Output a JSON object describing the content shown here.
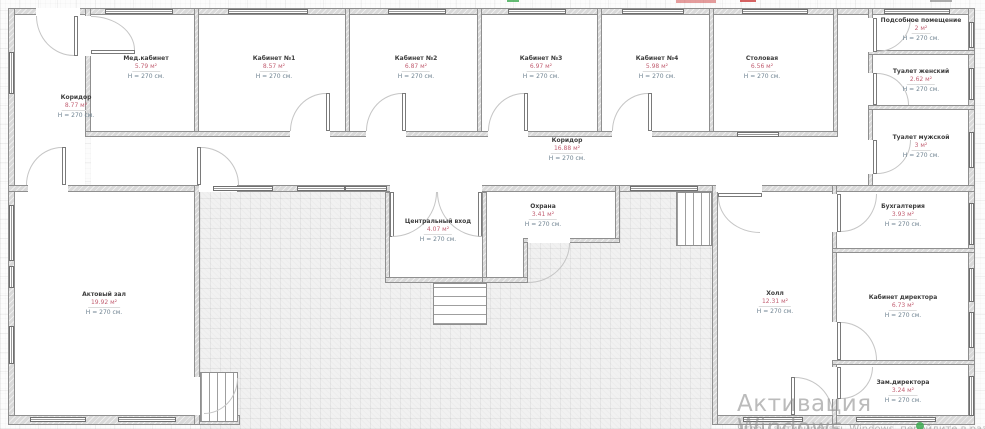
{
  "watermark": {
    "line1": "Активация Windows",
    "line2": "Чтобы активировать Windows, перейдите в раздел \"Параметры\"."
  },
  "rooms": [
    {
      "id": "corridor-left",
      "name": "Коридор",
      "area": "8.77 м²",
      "height": "H = 270 см."
    },
    {
      "id": "med-office",
      "name": "Мед.кабинет",
      "area": "5.79 м²",
      "height": "H = 270 см."
    },
    {
      "id": "office-1",
      "name": "Кабинет №1",
      "area": "8.57 м²",
      "height": "H = 270 см."
    },
    {
      "id": "office-2",
      "name": "Кабинет №2",
      "area": "6.87 м²",
      "height": "H = 270 см."
    },
    {
      "id": "office-3",
      "name": "Кабинет №3",
      "area": "6.97 м²",
      "height": "H = 270 см."
    },
    {
      "id": "office-4",
      "name": "Кабинет №4",
      "area": "5.98 м²",
      "height": "H = 270 см."
    },
    {
      "id": "dining-room",
      "name": "Столовая",
      "area": "6.56 м²",
      "height": "H = 270 см."
    },
    {
      "id": "utility-room",
      "name": "Подсобное помещение",
      "area": "2 м²",
      "height": "H = 270 см."
    },
    {
      "id": "wc-women",
      "name": "Туалет женский",
      "area": "2.62 м²",
      "height": "H = 270 см."
    },
    {
      "id": "wc-men",
      "name": "Туалет мужской",
      "area": "3 м²",
      "height": "H = 270 см."
    },
    {
      "id": "corridor-main",
      "name": "Коридор",
      "area": "16.88 м²",
      "height": "H = 270 см."
    },
    {
      "id": "assembly-hall",
      "name": "Актовый зал",
      "area": "19.92 м²",
      "height": "H = 270 см."
    },
    {
      "id": "main-entrance",
      "name": "Центральный вход",
      "area": "4.07 м²",
      "height": "H = 270 см."
    },
    {
      "id": "security",
      "name": "Охрана",
      "area": "3.41 м²",
      "height": "H = 270 см."
    },
    {
      "id": "hall",
      "name": "Холл",
      "area": "12.31 м²",
      "height": "H = 270 см."
    },
    {
      "id": "accounting",
      "name": "Бухгалтерия",
      "area": "3.93 м²",
      "height": "H = 270 см."
    },
    {
      "id": "director-office",
      "name": "Кабинет директора",
      "area": "6.73 м²",
      "height": "H = 270 см."
    },
    {
      "id": "deputy-director",
      "name": "Зам.директора",
      "area": "3.24 м²",
      "height": "H = 270 см."
    }
  ],
  "colors": {
    "room_name": "#3c3c3c",
    "room_area": "#c25f72",
    "room_height": "#6e8290",
    "wall_fill": "#d9d9d9",
    "wall_border": "#8f8f8f",
    "watermark": "#8e8e8e",
    "artifact_red": "#cc3c3c",
    "artifact_green": "#3caa50"
  }
}
